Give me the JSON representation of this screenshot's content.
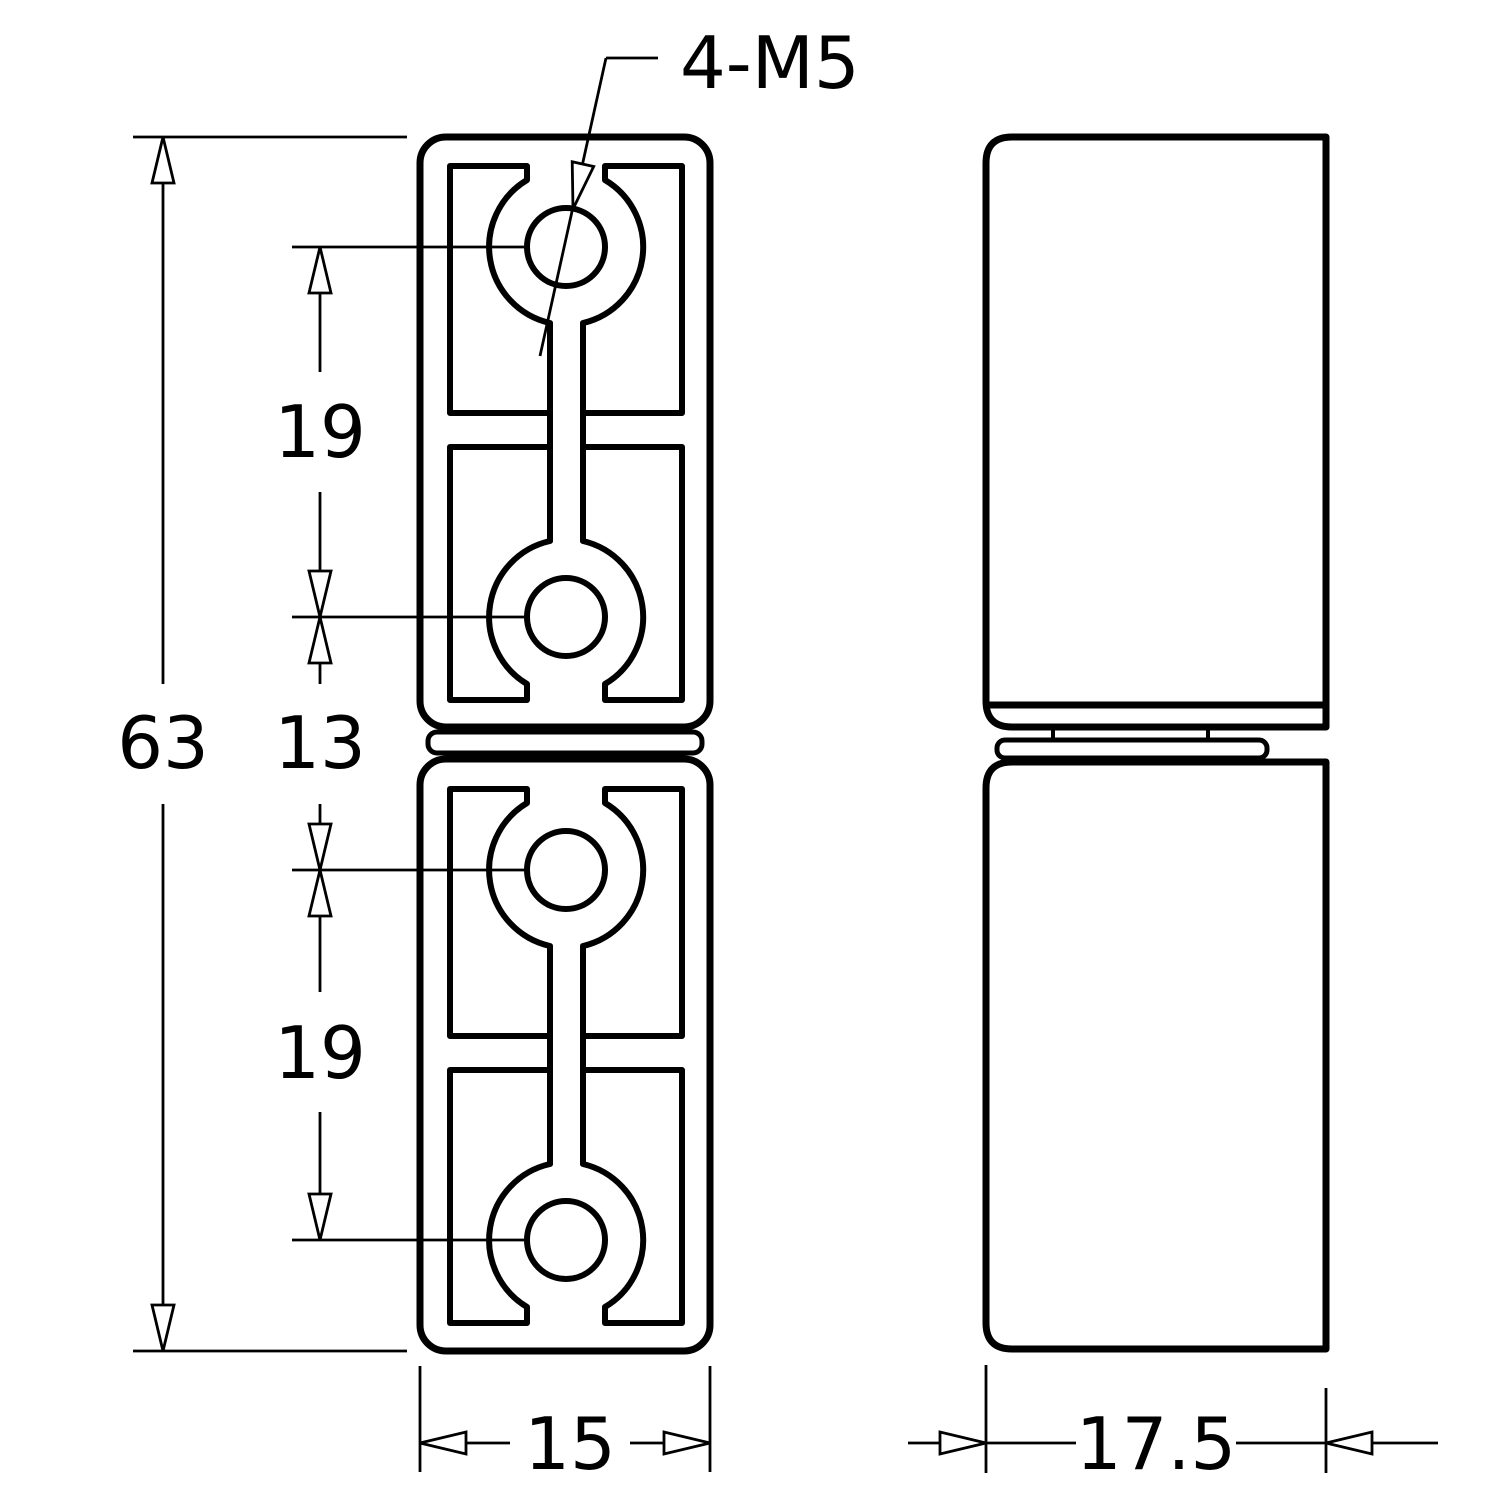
{
  "colors": {
    "line": "#000000",
    "background": "#ffffff"
  },
  "annotations": {
    "callout": "4-M5",
    "dimensions": {
      "overall_height": "63",
      "upper_hole_pitch": "19",
      "knuckle_span": "13",
      "lower_hole_pitch": "19",
      "front_view_width": "15",
      "side_view_width": "17.5"
    }
  }
}
